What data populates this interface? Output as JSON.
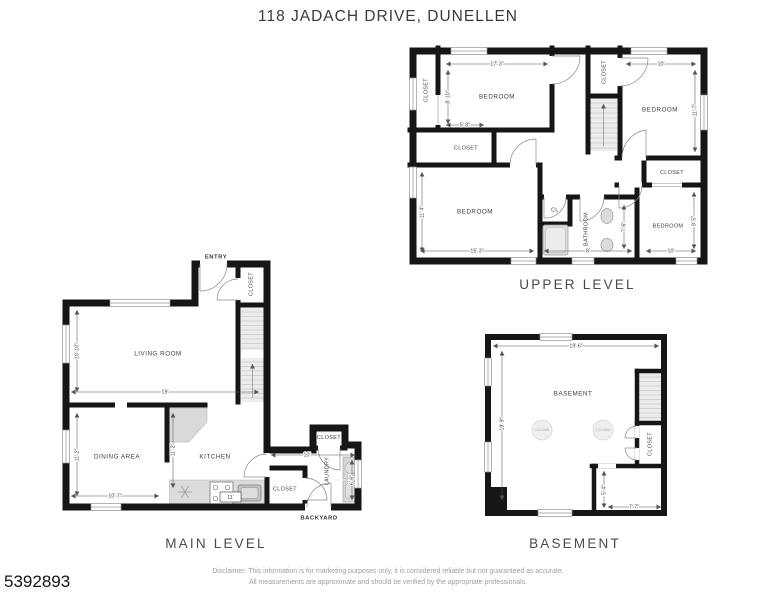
{
  "page": {
    "title": "118 JADACH DRIVE, DUNELLEN",
    "listing_id": "5392893",
    "disclaimer_line1": "Disclaimer: This information is for marketing purposes only, it is considered reliable but not guaranteed as accurate.",
    "disclaimer_line2": "All measurements are approximate and should be verified by the appropriate professionals."
  },
  "upper_level": {
    "label": "UPPER LEVEL",
    "rooms": {
      "bedroom_tl": "BEDROOM",
      "bedroom_tr": "BEDROOM",
      "bedroom_bl": "BEDROOM",
      "bedroom_br": "BEDROOM",
      "bathroom": "BATHROOM",
      "closet_left": "CLOSET",
      "closet_left_lower": "CLOSET",
      "closet_hall": "CLOSET",
      "closet_br": "CLOSET",
      "cl": "CL"
    },
    "dims": {
      "bedroom_tl_width": "17' 3\"",
      "bedroom_tl_depth": "8' 10\"",
      "closet_offset": "5' 8\"",
      "bedroom_tr_width": "10'",
      "bedroom_tr_depth": "11' 7\"",
      "bedroom_bl_depth": "11' 4\"",
      "bedroom_bl_width": "15' 3\"",
      "bathroom_width": "8'",
      "bathroom_depth": "7' 6\"",
      "bedroom_br_depth": "9' 5\"",
      "bedroom_br_width": "10'"
    }
  },
  "main_level": {
    "label": "MAIN LEVEL",
    "rooms": {
      "entry": "ENTRY",
      "entry_closet": "CLOSET",
      "living_room": "LIVING ROOM",
      "dining_area": "DINING AREA",
      "kitchen": "KITCHEN",
      "kitchen_closet": "CLOSET",
      "laundry": "LAUNDRY",
      "laundry_closet": "CLOSET",
      "backyard": "BACKYARD"
    },
    "dims": {
      "living_depth": "10' 10\"",
      "living_width": "19'",
      "dining_depth": "11' 2\"",
      "dining_width": "10' 7\"",
      "kitchen_depth": "11' 2\"",
      "kitchen_width": "11'",
      "laundry_width": "10'",
      "laundry_depth": "6' 6\""
    }
  },
  "basement": {
    "label": "BASEMENT",
    "rooms": {
      "basement": "BASEMENT",
      "closet": "CLOSET",
      "column_left": "COLUMN",
      "column_right": "COLUMN"
    },
    "dims": {
      "width": "19' 6\"",
      "depth": "19' 9\"",
      "storage_depth": "5' 4\"",
      "storage_width": "7' 7\""
    }
  }
}
